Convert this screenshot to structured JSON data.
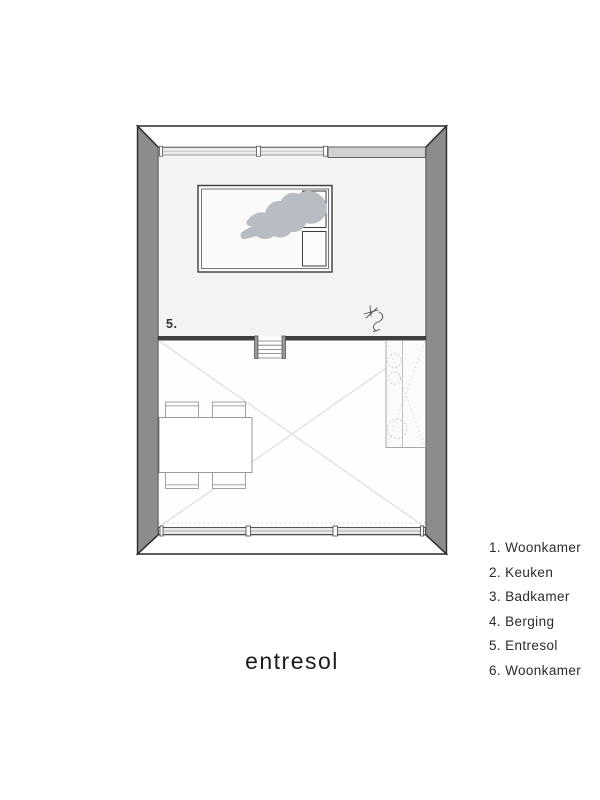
{
  "title": "entresol",
  "legend": {
    "items": [
      {
        "number": "1.",
        "label": "Woonkamer"
      },
      {
        "number": "2.",
        "label": "Keuken"
      },
      {
        "number": "3.",
        "label": "Badkamer"
      },
      {
        "number": "4.",
        "label": "Berging"
      },
      {
        "number": "5.",
        "label": "Entresol"
      },
      {
        "number": "6.",
        "label": "Woonkamer"
      }
    ]
  },
  "plan": {
    "room_label": "5.",
    "colors": {
      "wall_gray": "#8c8c8c",
      "outline": "#2a2a2a",
      "mezzanine_floor": "#f4f3f1",
      "person_silhouette": "#b7bdc2",
      "window_sill_gray": "#d2d1cf",
      "void_line_gray": "#dbdad8"
    },
    "icons": [
      "bed-icon",
      "pillow-icon",
      "person-silhouette-icon",
      "plant-sketch-icon",
      "stairs-icon",
      "void-cross-icon",
      "dining-table-icon",
      "chair-icon",
      "kitchen-counter-icon"
    ]
  }
}
